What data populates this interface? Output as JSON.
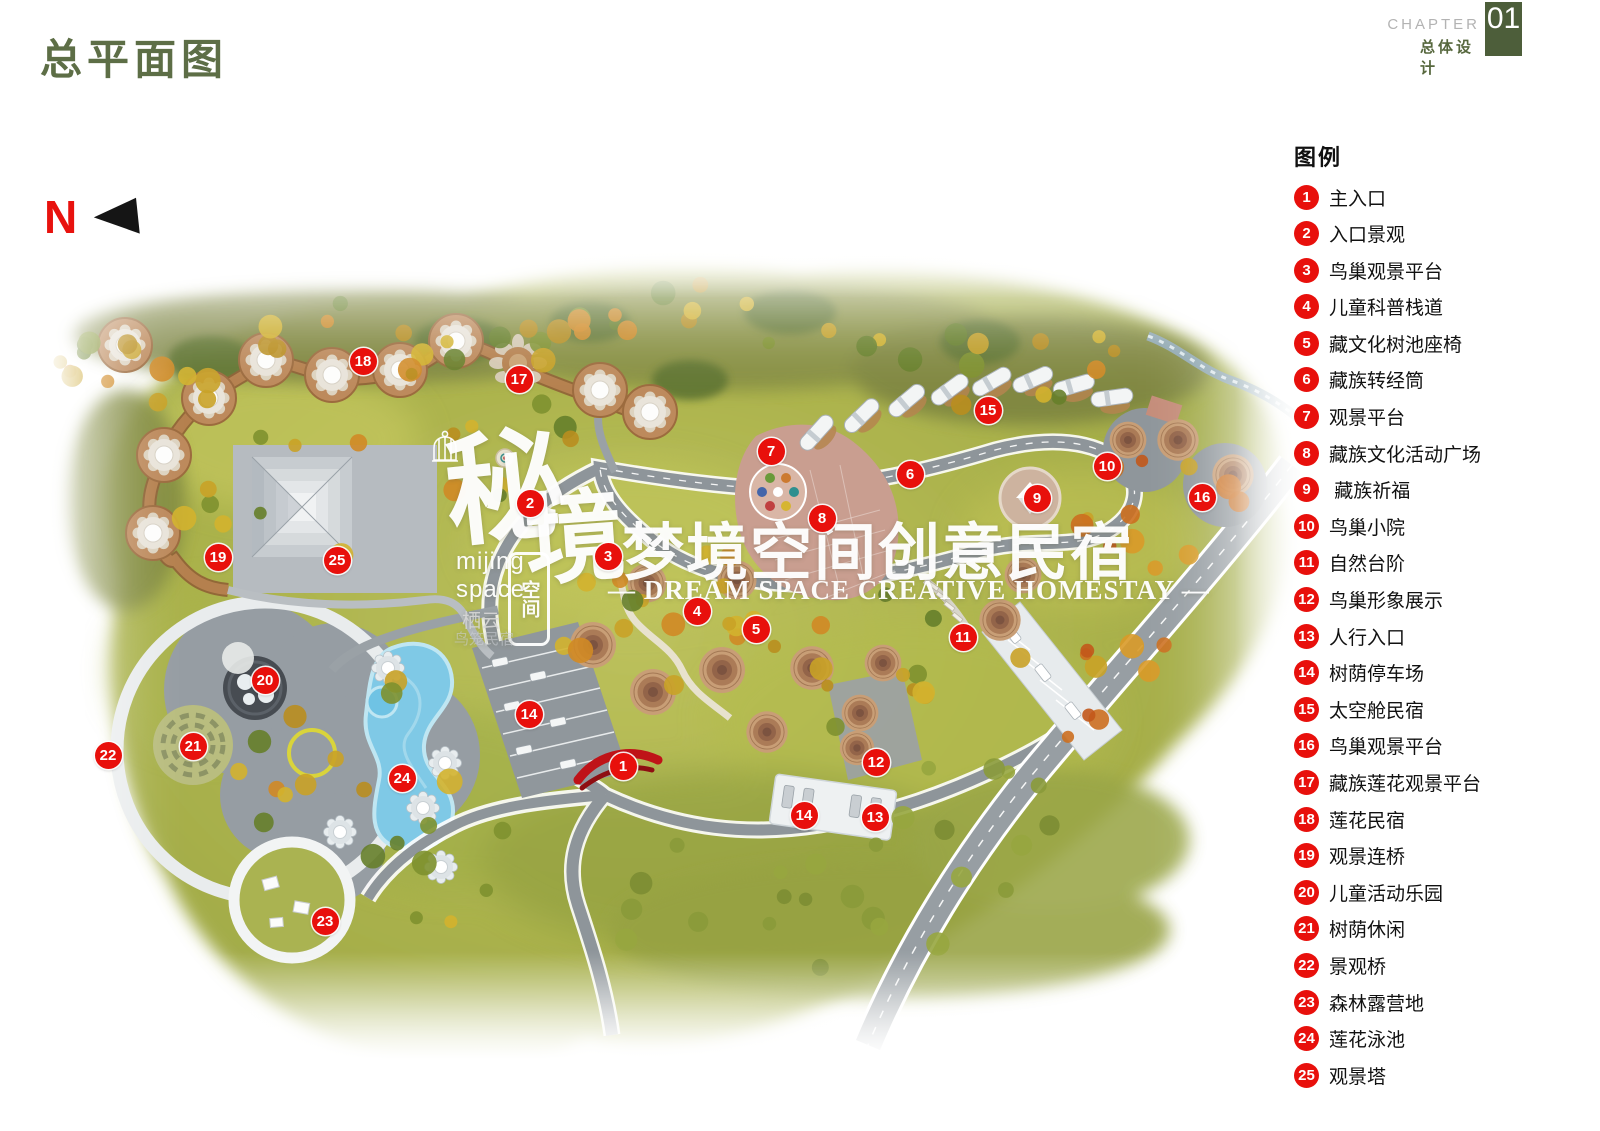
{
  "page": {
    "title": "总平面图"
  },
  "chapter": {
    "label": "CHAPTER",
    "number": "01",
    "subtitle": "总体设计"
  },
  "north": {
    "label": "N"
  },
  "legend": {
    "title": "图例",
    "items": [
      {
        "num": "1",
        "label": "主入口"
      },
      {
        "num": "2",
        "label": "入口景观"
      },
      {
        "num": "3",
        "label": "鸟巢观景平台"
      },
      {
        "num": "4",
        "label": "儿童科普栈道"
      },
      {
        "num": "5",
        "label": "藏文化树池座椅"
      },
      {
        "num": "6",
        "label": "藏族转经筒"
      },
      {
        "num": "7",
        "label": "观景平台"
      },
      {
        "num": "8",
        "label": "藏族文化活动广场"
      },
      {
        "num": "9",
        "label": " 藏族祈福"
      },
      {
        "num": "10",
        "label": "鸟巢小院"
      },
      {
        "num": "11",
        "label": "自然台阶"
      },
      {
        "num": "12",
        "label": "鸟巢形象展示"
      },
      {
        "num": "13",
        "label": "人行入口"
      },
      {
        "num": "14",
        "label": "树荫停车场"
      },
      {
        "num": "15",
        "label": "太空舱民宿"
      },
      {
        "num": "16",
        "label": "鸟巢观景平台"
      },
      {
        "num": "17",
        "label": "藏族莲花观景平台"
      },
      {
        "num": "18",
        "label": "莲花民宿"
      },
      {
        "num": "19",
        "label": "观景连桥"
      },
      {
        "num": "20",
        "label": "儿童活动乐园"
      },
      {
        "num": "21",
        "label": "树荫休闲"
      },
      {
        "num": "22",
        "label": "景观桥"
      },
      {
        "num": "23",
        "label": "森林露营地"
      },
      {
        "num": "24",
        "label": "莲花泳池"
      },
      {
        "num": "25",
        "label": "观景塔"
      }
    ]
  },
  "watermark": {
    "title_cn": "梦境空间创意民宿",
    "title_en": "— DREAM SPACE CREATIVE HOMESTAY —",
    "logo_cn_1": "秘",
    "logo_cn_2": "境",
    "logo_seal_text": "空间",
    "logo_en_1": "mijing",
    "logo_en_2": "space",
    "logo_sub_1": "栖云",
    "logo_sub_2": "鸟笼民宿"
  },
  "map": {
    "markers": [
      {
        "num": "1",
        "x": 623,
        "y": 766
      },
      {
        "num": "2",
        "x": 530,
        "y": 503
      },
      {
        "num": "3",
        "x": 608,
        "y": 556
      },
      {
        "num": "4",
        "x": 697,
        "y": 611
      },
      {
        "num": "5",
        "x": 756,
        "y": 629
      },
      {
        "num": "6",
        "x": 910,
        "y": 474
      },
      {
        "num": "7",
        "x": 771,
        "y": 451
      },
      {
        "num": "8",
        "x": 822,
        "y": 518
      },
      {
        "num": "9",
        "x": 1037,
        "y": 498
      },
      {
        "num": "10",
        "x": 1107,
        "y": 466
      },
      {
        "num": "11",
        "x": 963,
        "y": 637
      },
      {
        "num": "12",
        "x": 876,
        "y": 762
      },
      {
        "num": "13",
        "x": 875,
        "y": 817
      },
      {
        "num": "14",
        "x": 529,
        "y": 714
      },
      {
        "num": "14",
        "x": 804,
        "y": 815
      },
      {
        "num": "15",
        "x": 988,
        "y": 410
      },
      {
        "num": "16",
        "x": 1202,
        "y": 497
      },
      {
        "num": "17",
        "x": 519,
        "y": 379
      },
      {
        "num": "18",
        "x": 363,
        "y": 361
      },
      {
        "num": "19",
        "x": 218,
        "y": 557
      },
      {
        "num": "20",
        "x": 265,
        "y": 680
      },
      {
        "num": "21",
        "x": 193,
        "y": 746
      },
      {
        "num": "22",
        "x": 108,
        "y": 755
      },
      {
        "num": "23",
        "x": 325,
        "y": 921
      },
      {
        "num": "24",
        "x": 402,
        "y": 778
      },
      {
        "num": "25",
        "x": 337,
        "y": 560
      }
    ]
  },
  "colors": {
    "accent_red": "#e8100c",
    "title_green": "#5d6e46",
    "chapter_box_green": "#4d5e3a",
    "chapter_gray": "#b3b3b3"
  }
}
